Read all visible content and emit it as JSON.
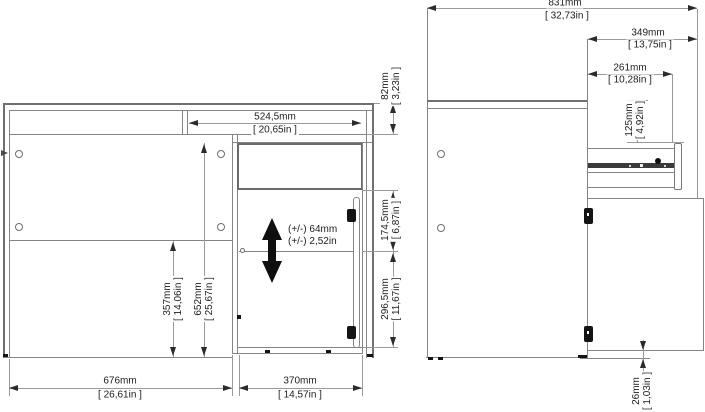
{
  "front_view": {
    "drawer_width": {
      "mm": "524,5mm",
      "inch": "[ 20,65in ]"
    },
    "top_height": {
      "mm": "82mm",
      "inch": "[ 3,23in ]"
    },
    "door_upper_height": {
      "mm": "174,5mm",
      "inch": "[ 6,87in ]"
    },
    "door_lower_height": {
      "mm": "296,5mm",
      "inch": "[ 11,67in ]"
    },
    "kneespace_height": {
      "mm": "357mm",
      "inch": "[ 14,06in ]"
    },
    "interior_height": {
      "mm": "652mm",
      "inch": "[ 25,67in ]"
    },
    "kneespace_width": {
      "mm": "676mm",
      "inch": "[ 26,61in ]"
    },
    "cabinet_width": {
      "mm": "370mm",
      "inch": "[ 14,57in ]"
    },
    "shelf_adjustment": {
      "mm": "(+/-) 64mm",
      "inch": "(+/-) 2,52in"
    }
  },
  "side_view": {
    "total_depth": {
      "mm": "831mm",
      "inch": "[ 32,73in ]"
    },
    "drawer_extension": {
      "mm": "349mm",
      "inch": "[ 13,75in ]"
    },
    "slide_travel": {
      "mm": "261mm",
      "inch": "[ 10,28in ]"
    },
    "drawer_top_offset": {
      "mm": "125mm",
      "inch": "[ 4,92in ]"
    },
    "floor_clearance": {
      "mm": "26mm",
      "inch": "[ 1,03in ]"
    }
  }
}
